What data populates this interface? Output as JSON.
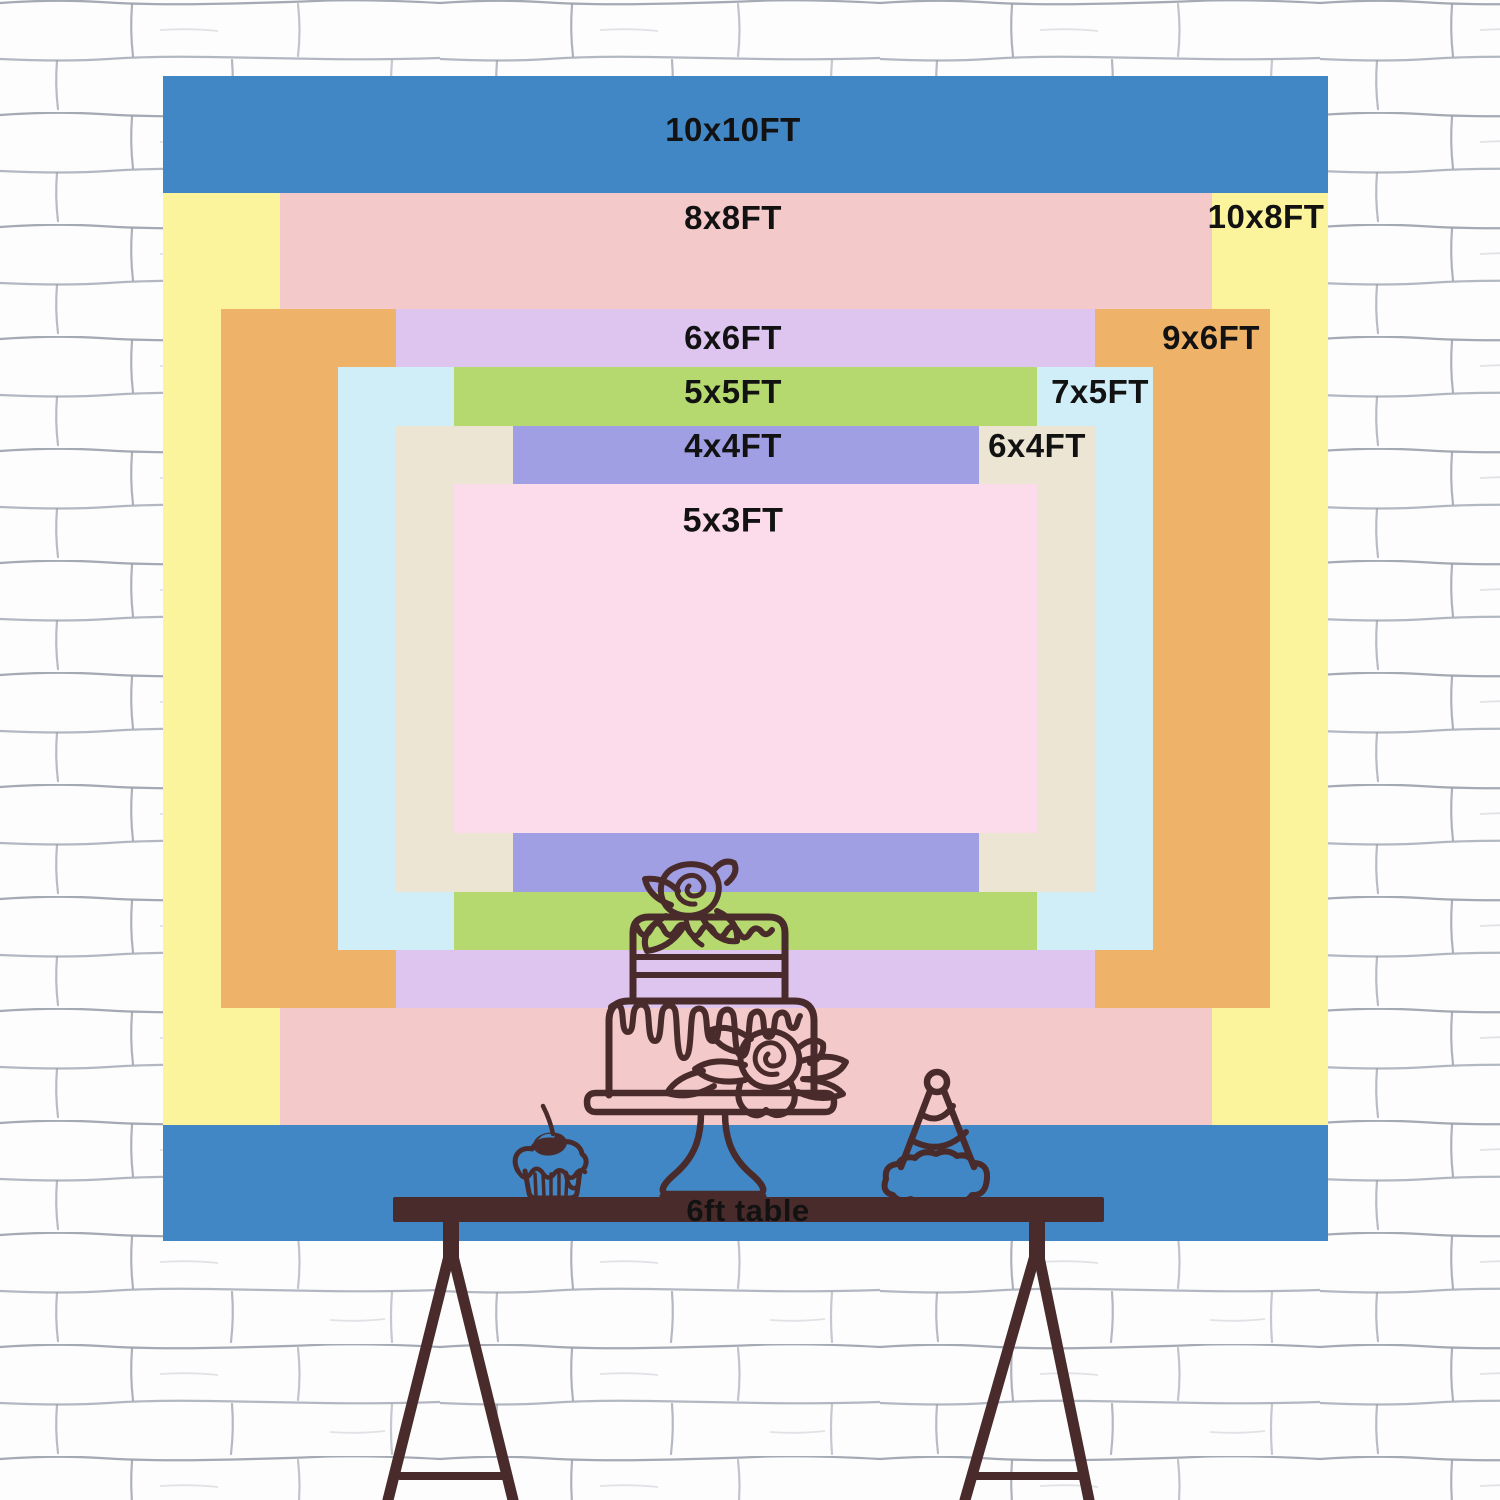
{
  "title": "Backdrop size comparison chart",
  "backdrop": {
    "scale_px_per_ft": 116.5,
    "center": {
      "x": 745.5,
      "y": 658.5
    },
    "rects": [
      {
        "name": "10x10ft",
        "label": "10x10FT",
        "w_ft": 10,
        "h_ft": 10,
        "color": "#4287c5"
      },
      {
        "name": "10x8ft",
        "label": "10x8FT",
        "w_ft": 10,
        "h_ft": 8,
        "color": "#fcf49c"
      },
      {
        "name": "8x8ft",
        "label": "8x8FT",
        "w_ft": 8,
        "h_ft": 8,
        "color": "#f3c9ca"
      },
      {
        "name": "9x6ft",
        "label": "9x6FT",
        "w_ft": 9,
        "h_ft": 6,
        "color": "#eeb269"
      },
      {
        "name": "6x6ft",
        "label": "6x6FT",
        "w_ft": 6,
        "h_ft": 6,
        "color": "#ddc5ef"
      },
      {
        "name": "7x5ft",
        "label": "7x5FT",
        "w_ft": 7,
        "h_ft": 5,
        "color": "#cfeef8"
      },
      {
        "name": "5x5ft",
        "label": "5x5FT",
        "w_ft": 5,
        "h_ft": 5,
        "color": "#b5d96e"
      },
      {
        "name": "6x4ft",
        "label": "6x4FT",
        "w_ft": 6,
        "h_ft": 4,
        "color": "#ece5d3"
      },
      {
        "name": "4x4ft",
        "label": "4x4FT",
        "w_ft": 4,
        "h_ft": 4,
        "color": "#a09fe4"
      },
      {
        "name": "5x3ft",
        "label": "5x3FT",
        "w_ft": 5,
        "h_ft": 3,
        "color": "#fcdcea"
      }
    ]
  },
  "labels": [
    {
      "text": "10x10FT",
      "x": 733,
      "y": 130,
      "size": 33
    },
    {
      "text": "8x8FT",
      "x": 733,
      "y": 218,
      "size": 33
    },
    {
      "text": "10x8FT",
      "x": 1266,
      "y": 217,
      "size": 33
    },
    {
      "text": "6x6FT",
      "x": 733,
      "y": 338,
      "size": 33
    },
    {
      "text": "9x6FT",
      "x": 1211,
      "y": 338,
      "size": 33
    },
    {
      "text": "5x5FT",
      "x": 733,
      "y": 392,
      "size": 33
    },
    {
      "text": "7x5FT",
      "x": 1100,
      "y": 392,
      "size": 33
    },
    {
      "text": "4x4FT",
      "x": 733,
      "y": 446,
      "size": 33
    },
    {
      "text": "6x4FT",
      "x": 1037,
      "y": 446,
      "size": 33
    },
    {
      "text": "5x3FT",
      "x": 733,
      "y": 521,
      "size": 34
    },
    {
      "text": "6ft table",
      "x": 748,
      "y": 1211,
      "size": 31
    }
  ],
  "table": {
    "label": "6ft table",
    "color": "#4a2b2b"
  },
  "art": {
    "line_color": "#4a2b2b",
    "cherry_highlight": "#4287c5"
  },
  "wall": {
    "background": "#fdfdfe",
    "line_color": "#9aa0ac"
  }
}
